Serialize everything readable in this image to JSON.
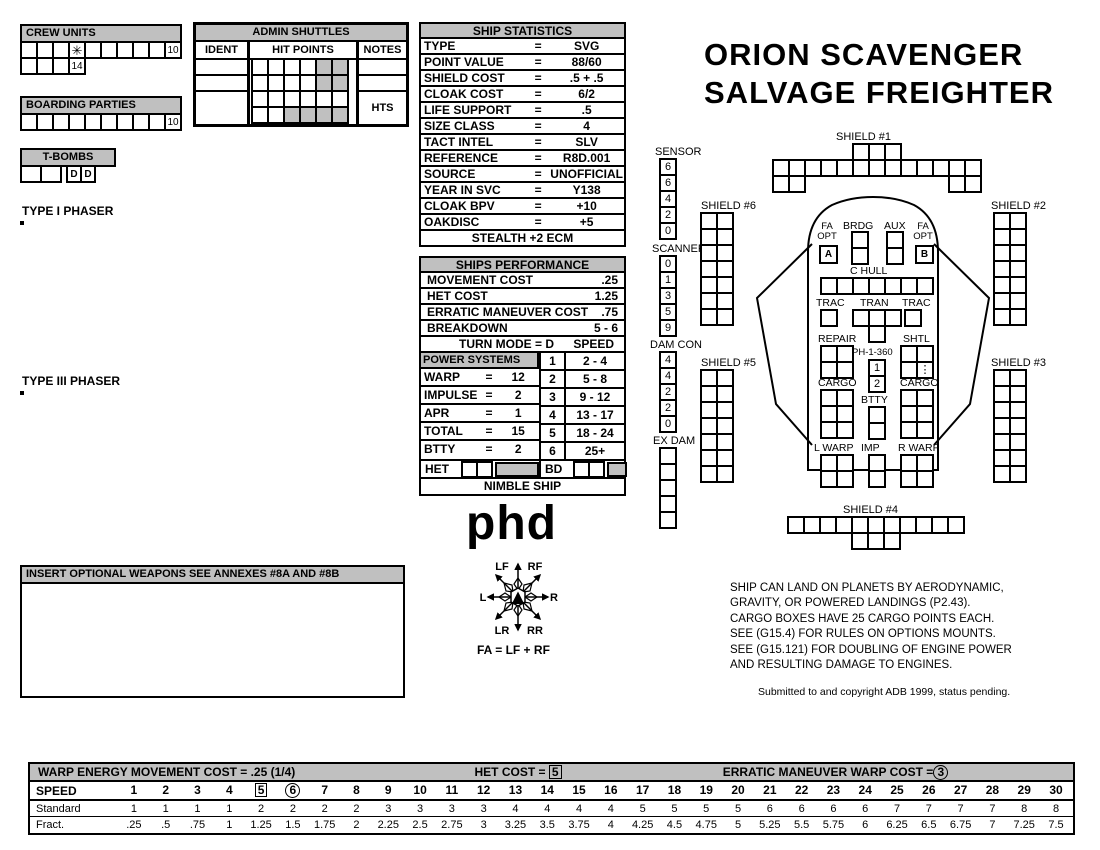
{
  "title": {
    "line1": "ORION SCAVENGER",
    "line2": "SALVAGE FREIGHTER"
  },
  "crew_units": {
    "label": "CREW UNITS",
    "row1": [
      "",
      "",
      "",
      {
        "t": "✳",
        "cls": "star"
      },
      "",
      "",
      "",
      "",
      "",
      "10"
    ],
    "row2": [
      "",
      "",
      "",
      "14"
    ]
  },
  "boarding_parties": {
    "label": "BOARDING PARTIES",
    "row": [
      "",
      "",
      "",
      "",
      "",
      "",
      "",
      "",
      "",
      "10"
    ]
  },
  "t_bombs": {
    "label": "T-BOMBS",
    "big_cells": [
      "",
      ""
    ],
    "d_cells": [
      {
        "t": "D",
        "cls": "bold"
      },
      {
        "t": "D",
        "cls": "bold"
      }
    ]
  },
  "admin_shuttles": {
    "title": "ADMIN SHUTTLES",
    "col_ident": "IDENT",
    "col_hit": "HIT POINTS",
    "col_notes": "NOTES",
    "hit_grid": [
      "",
      "",
      "",
      "",
      {
        "g": true
      },
      {
        "g": true
      },
      "",
      "",
      "",
      "",
      {
        "g": true
      },
      {
        "g": true
      },
      "",
      "",
      "",
      "",
      "",
      "",
      "",
      "",
      {
        "g": true
      },
      {
        "g": true
      },
      {
        "g": true
      },
      {
        "g": true
      }
    ],
    "row3_note": "HTS"
  },
  "ship_statistics": {
    "title": "SHIP STATISTICS",
    "rows": [
      [
        "TYPE",
        "=",
        "SVG"
      ],
      [
        "POINT VALUE",
        "=",
        "88/60"
      ],
      [
        "SHIELD COST",
        "=",
        ".5 + .5"
      ],
      [
        "CLOAK COST",
        "=",
        "6/2"
      ],
      [
        "LIFE SUPPORT",
        "=",
        ".5"
      ],
      [
        "SIZE CLASS",
        "=",
        "4"
      ],
      [
        "TACT INTEL",
        "=",
        "SLV"
      ],
      [
        "REFERENCE",
        "=",
        "R8D.001"
      ],
      [
        "SOURCE",
        "=",
        "UNOFFICIAL"
      ],
      [
        "YEAR IN SVC",
        "=",
        "Y138"
      ],
      [
        "CLOAK BPV",
        "=",
        "+10"
      ],
      [
        "OAKDISC",
        "=",
        "+5"
      ]
    ],
    "footer": "STEALTH +2 ECM"
  },
  "performance": {
    "title": "SHIPS PERFORMANCE",
    "top": [
      [
        "MOVEMENT COST",
        ".25"
      ],
      [
        "HET COST",
        "1.25"
      ],
      [
        "ERRATIC MANEUVER COST",
        ".75"
      ],
      [
        "BREAKDOWN",
        "5 - 6"
      ]
    ],
    "turn_mode_label": "TURN MODE = D",
    "speed_label": "SPEED",
    "power_header": "POWER SYSTEMS",
    "power_rows": [
      [
        "WARP",
        "=",
        "12"
      ],
      [
        "IMPULSE",
        "=",
        "2"
      ],
      [
        "APR",
        "=",
        "1"
      ],
      [
        "TOTAL",
        "=",
        "15"
      ],
      [
        "BTTY",
        "=",
        "2"
      ]
    ],
    "speed_rows": [
      [
        "1",
        "2 - 4"
      ],
      [
        "2",
        "5 - 8"
      ],
      [
        "3",
        "9 - 12"
      ],
      [
        "4",
        "13 - 17"
      ],
      [
        "5",
        "18 - 24"
      ],
      [
        "6",
        "25+"
      ]
    ],
    "het_label": "HET",
    "bd_label": "BD",
    "footer": "NIMBLE SHIP"
  },
  "type1_phaser": {
    "title": "TYPE I PHASER",
    "header_top": [
      "DIE",
      "RANGE",
      "",
      "",
      "",
      "",
      "",
      "6-",
      "9-",
      "16-",
      "26-",
      "51-"
    ],
    "header_bot": [
      "ROLL",
      "0",
      "1",
      "2",
      "3",
      "4",
      "5",
      "8",
      "15",
      "25",
      "50",
      "75"
    ],
    "rows": [
      [
        "1",
        "9",
        "8",
        "7",
        "6",
        "5",
        "5",
        "4",
        "3",
        "2",
        "1",
        "1"
      ],
      [
        "2",
        "8",
        "7",
        "6",
        "5",
        "5",
        "4",
        "3",
        "2",
        "1",
        "1",
        "0"
      ],
      [
        "3",
        "7",
        "5",
        "5",
        "4",
        "4",
        "4",
        "3",
        "1",
        "0",
        "0",
        "0"
      ],
      [
        "4",
        "6",
        "4",
        "4",
        "4",
        "4",
        "3",
        "2",
        "0",
        "0",
        "0",
        "0"
      ],
      [
        "5",
        "5",
        "4",
        "4",
        "4",
        "3",
        "3",
        "1",
        "0",
        "0",
        "0",
        "0"
      ],
      [
        "6",
        "4",
        "4",
        "3",
        "3",
        "2",
        "2",
        "0",
        "0",
        "0",
        "0",
        "0"
      ]
    ]
  },
  "type3_phaser": {
    "title": "TYPE III PHASER",
    "header_top": [
      "DIE",
      "RANGE",
      "",
      "",
      "",
      "4-",
      "9-"
    ],
    "header_bot": [
      "ROLL",
      "0",
      "1",
      "2",
      "3",
      "8",
      "15"
    ],
    "rows": [
      [
        "1",
        "4",
        "4",
        "4",
        "3",
        "1",
        "1"
      ],
      [
        "2",
        "4",
        "4",
        "4",
        "2",
        "1",
        "0"
      ],
      [
        "3",
        "4",
        "4",
        "4",
        "1",
        "0",
        "0"
      ],
      [
        "4",
        "4",
        "4",
        "3",
        "0",
        "0",
        "0"
      ],
      [
        "5",
        "4",
        "3",
        "2",
        "0",
        "0",
        "0"
      ],
      [
        "6",
        "3",
        "3",
        "1",
        "0",
        "0",
        "0"
      ]
    ]
  },
  "optional_weapons": {
    "header": "INSERT OPTIONAL WEAPONS   SEE ANNEXES #8A AND #8B"
  },
  "phd": "phd",
  "arcs": {
    "lf": "LF",
    "rf": "RF",
    "l": "L",
    "r": "R",
    "lr": "LR",
    "rr": "RR",
    "formula": "FA = LF + RF"
  },
  "tracks": {
    "sensor": {
      "label": "SENSOR",
      "cells": [
        "6",
        "6",
        "4",
        "2",
        "0"
      ]
    },
    "scanner": {
      "label": "SCANNER",
      "cells": [
        "0",
        "1",
        "3",
        "5",
        "9"
      ]
    },
    "dam_con": {
      "label": "DAM CON",
      "cells": [
        "4",
        "4",
        "2",
        "2",
        "0"
      ]
    },
    "ex_dam": {
      "label": "EX DAM"
    }
  },
  "shields": {
    "s1": {
      "label": "SHIELD #1"
    },
    "s2": {
      "label": "SHIELD #2"
    },
    "s3": {
      "label": "SHIELD #3"
    },
    "s4": {
      "label": "SHIELD #4"
    },
    "s5": {
      "label": "SHIELD #5"
    },
    "s6": {
      "label": "SHIELD #6"
    }
  },
  "ship_boxes": {
    "shield_side": 14,
    "s1_top": 3,
    "s1_mid": 13,
    "s1_bl": 2,
    "s1_br": 2,
    "s4_top": 11,
    "s4_bottom": 3,
    "ex_dam": 5,
    "brdg": 2,
    "aux": 2,
    "c_hull": 7,
    "trac": 1,
    "tran_top": 3,
    "tran_bottom": 1,
    "repair": 4,
    "cargo": 6,
    "btty": 2,
    "l_warp": 4,
    "imp": 2,
    "r_warp": 4,
    "het_cells": 2,
    "bd_cells": 2
  },
  "ship": {
    "fa_opt_a": {
      "label1": "FA",
      "label2": "OPT",
      "box": [
        {
          "t": "A",
          "cls": "bold"
        }
      ]
    },
    "fa_opt_b": {
      "label1": "FA",
      "label2": "OPT",
      "box": [
        {
          "t": "B",
          "cls": "bold"
        }
      ]
    },
    "brdg": "BRDG",
    "aux": "AUX",
    "c_hull": "C HULL",
    "trac": "TRAC",
    "tran": "TRAN",
    "repair": "REPAIR",
    "ph_label": "PH-1-360",
    "ph_boxes": [
      "1",
      "2"
    ],
    "shtl": "SHTL",
    "shtl_cells": [
      "",
      "",
      "",
      {
        "t": "⋮",
        "cls": "dots"
      }
    ],
    "cargo": "CARGO",
    "btty": "BTTY",
    "l_warp": "L WARP",
    "imp": "IMP",
    "r_warp": "R WARP"
  },
  "notes": {
    "lines": [
      "SHIP CAN LAND ON PLANETS BY AERODYNAMIC,",
      "GRAVITY, OR POWERED LANDINGS (P2.43).",
      "CARGO BOXES HAVE 25 CARGO POINTS EACH.",
      "SEE (G15.4) FOR RULES ON OPTIONS MOUNTS.",
      "SEE (G15.121) FOR DOUBLING OF ENGINE POWER",
      "AND RESULTING DAMAGE TO ENGINES."
    ],
    "copyright": "Submitted to and copyright ADB 1999, status pending."
  },
  "speed_chart": {
    "header_left": "WARP ENERGY MOVEMENT COST = .25  (1/4)",
    "header_het": "HET COST = ",
    "het_value": "5",
    "header_erratic": "ERRATIC MANEUVER WARP COST =",
    "erratic_value": "3",
    "speed_label": "SPEED",
    "standard_label": "Standard",
    "fract_label": "Fract.",
    "speeds": [
      "1",
      "2",
      "3",
      "4",
      {
        "t": "5",
        "cls": "boxed"
      },
      {
        "t": "6",
        "cls": "circled"
      },
      "7",
      "8",
      "9",
      "10",
      "11",
      "12",
      "13",
      "14",
      "15",
      "16",
      "17",
      "18",
      "19",
      "20",
      "21",
      "22",
      "23",
      "24",
      "25",
      "26",
      "27",
      "28",
      "29",
      "30"
    ],
    "standard": [
      "1",
      "1",
      "1",
      "1",
      "2",
      "2",
      "2",
      "2",
      "3",
      "3",
      "3",
      "3",
      "4",
      "4",
      "4",
      "4",
      "5",
      "5",
      "5",
      "5",
      "6",
      "6",
      "6",
      "6",
      "7",
      "7",
      "7",
      "7",
      "8",
      "8"
    ],
    "fract": [
      ".25",
      ".5",
      ".75",
      "1",
      "1.25",
      "1.5",
      "1.75",
      "2",
      "2.25",
      "2.5",
      "2.75",
      "3",
      "3.25",
      "3.5",
      "3.75",
      "4",
      "4.25",
      "4.5",
      "4.75",
      "5",
      "5.25",
      "5.5",
      "5.75",
      "6",
      "6.25",
      "6.5",
      "6.75",
      "7",
      "7.25",
      "7.5"
    ]
  }
}
